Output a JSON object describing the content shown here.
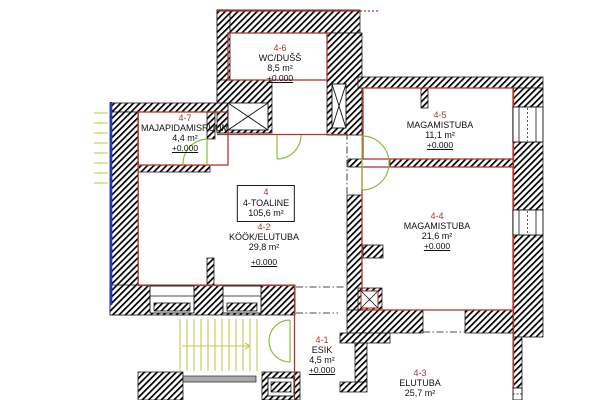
{
  "plan": {
    "apartment": {
      "id": "4",
      "name": "4-TOALINE",
      "area": "105,6 m²"
    },
    "rooms": [
      {
        "id": "4-6",
        "name": "WC/DUŠŠ",
        "area": "8,5 m²",
        "elevation": "+0.000"
      },
      {
        "id": "4-7",
        "name": "MAJAPIDAMISRUUM",
        "area": "4,4 m²",
        "elevation": "+0.000"
      },
      {
        "id": "4-5",
        "name": "MAGAMISTUBA",
        "area": "11,1 m²",
        "elevation": "+0.000"
      },
      {
        "id": "4-2",
        "name": "KÖÖK/ELUTUBA",
        "area": "29,8 m²",
        "elevation": "+0.000"
      },
      {
        "id": "4-4",
        "name": "MAGAMISTUBA",
        "area": "21,6 m²",
        "elevation": "+0.000"
      },
      {
        "id": "4-1",
        "name": "ESIK",
        "area": "4,5 m²",
        "elevation": "+0.000"
      },
      {
        "id": "4-3",
        "name": "ELUTUBA",
        "area": "25,7 m²"
      }
    ],
    "colors": {
      "boundary_red": "#b23530",
      "wall_hatch": "#000000",
      "door_green": "#86c13d",
      "stair_green": "#b9cf55",
      "marker_blue": "#2636b8"
    }
  }
}
